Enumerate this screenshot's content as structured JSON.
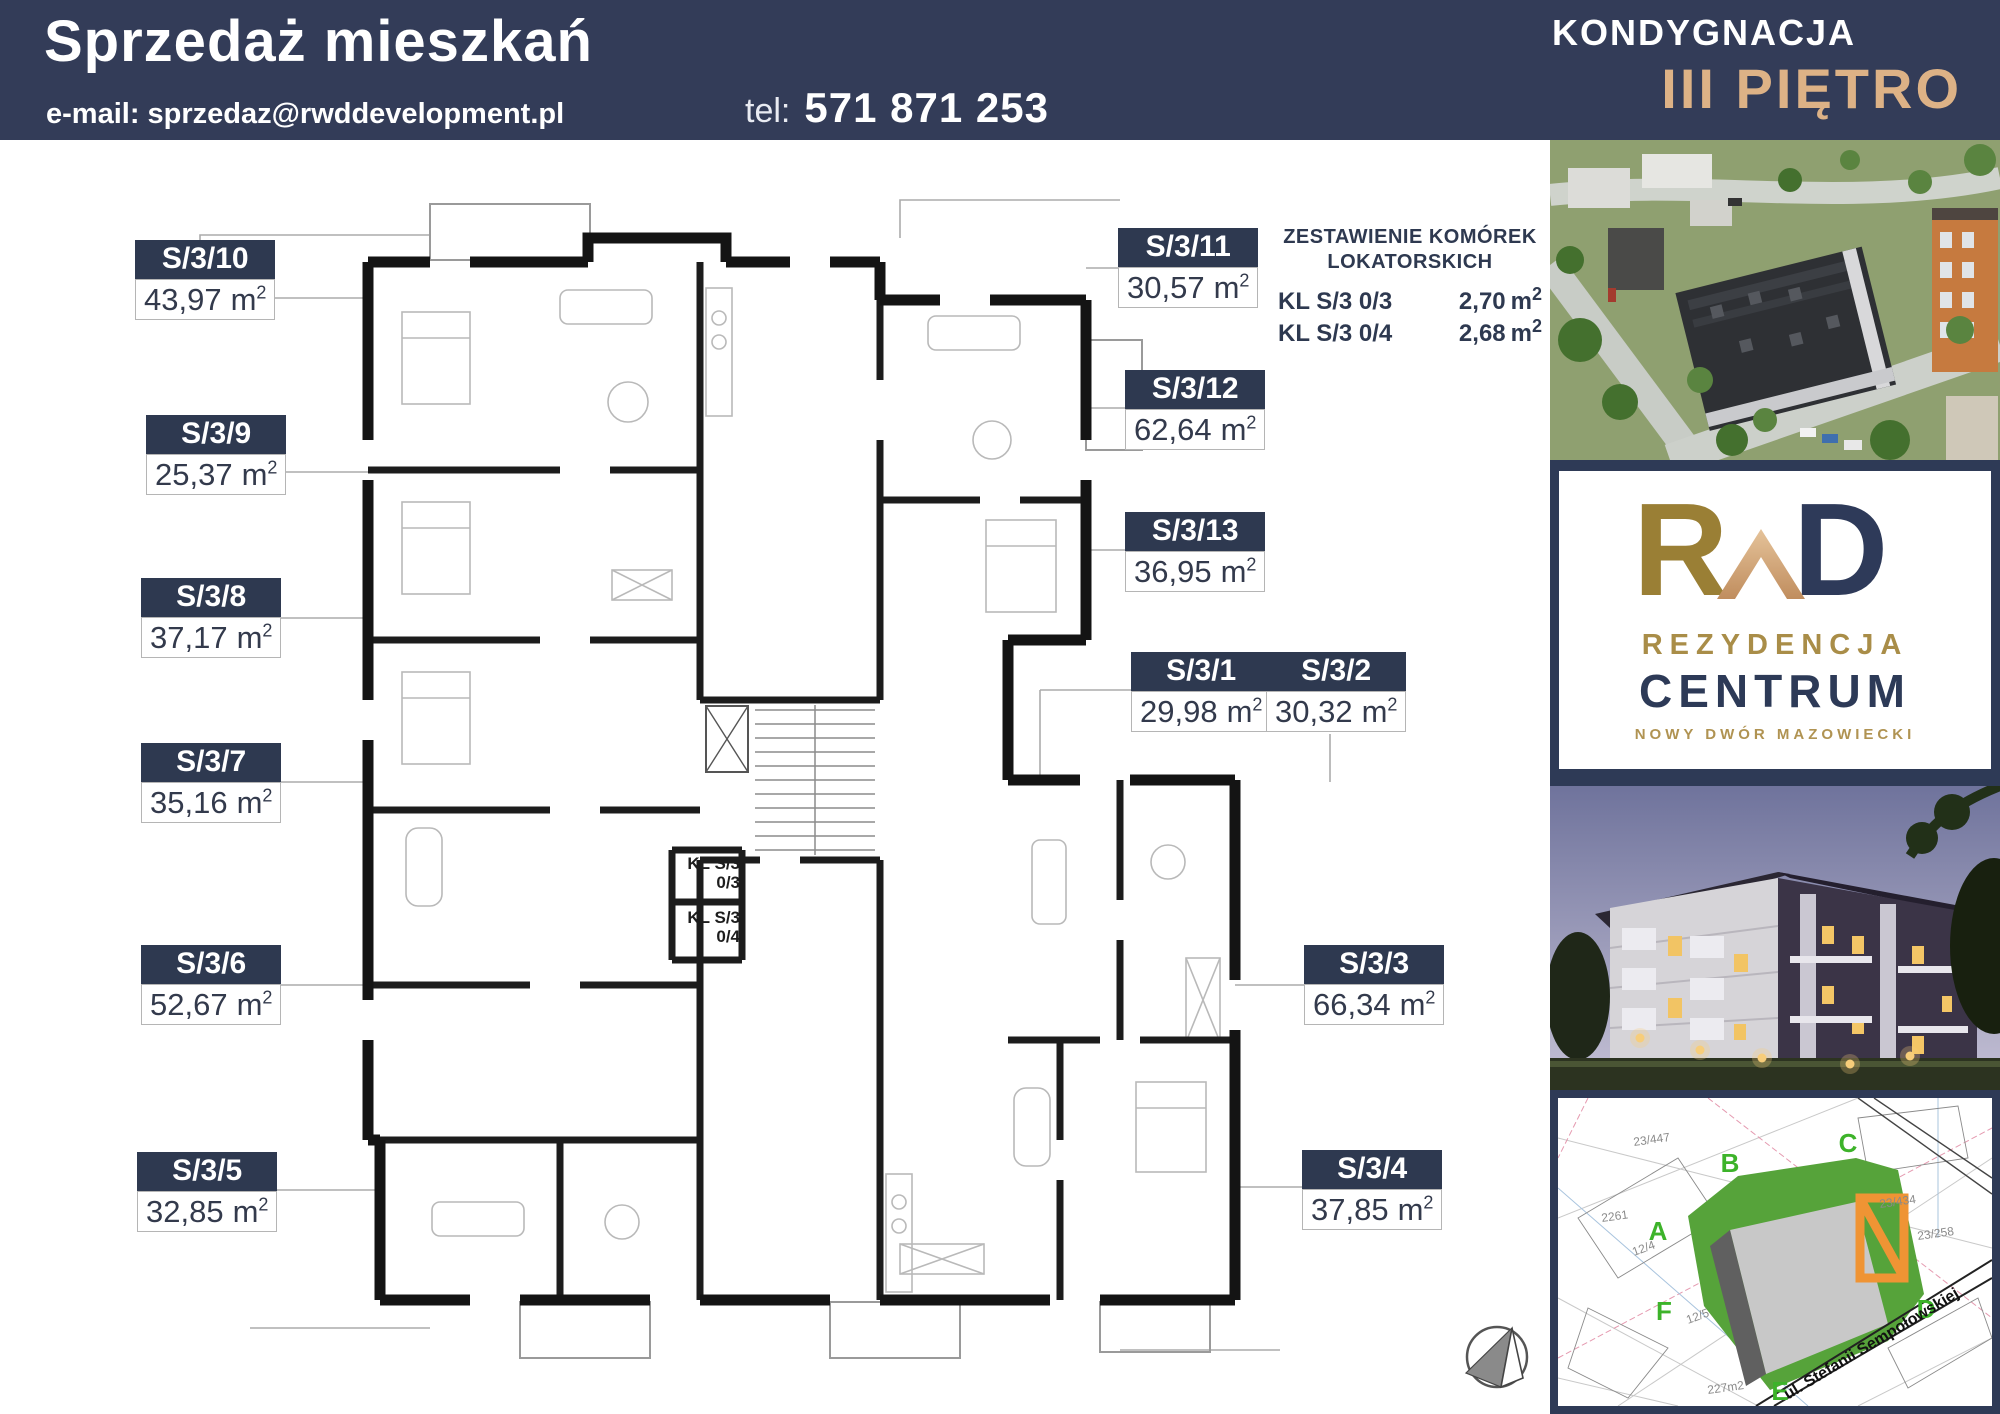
{
  "header": {
    "title": "Sprzedaż mieszkań",
    "email": "e-mail: sprzedaz@rwddevelopment.pl",
    "tel_label": "tel:",
    "tel_number": "571 871 253",
    "kondygnacja": "KONDYGNACJA",
    "floor": "III PIĘTRO"
  },
  "units": {
    "m": "m",
    "sup": "2"
  },
  "apartments": [
    {
      "id": "S/3/10",
      "area": "43,97"
    },
    {
      "id": "S/3/9",
      "area": "25,37"
    },
    {
      "id": "S/3/8",
      "area": "37,17"
    },
    {
      "id": "S/3/7",
      "area": "35,16"
    },
    {
      "id": "S/3/6",
      "area": "52,67"
    },
    {
      "id": "S/3/5",
      "area": "32,85"
    },
    {
      "id": "S/3/11",
      "area": "30,57"
    },
    {
      "id": "S/3/12",
      "area": "62,64"
    },
    {
      "id": "S/3/13",
      "area": "36,95"
    },
    {
      "id": "S/3/1",
      "area": "29,98"
    },
    {
      "id": "S/3/2",
      "area": "30,32"
    },
    {
      "id": "S/3/3",
      "area": "66,34"
    },
    {
      "id": "S/3/4",
      "area": "37,85"
    }
  ],
  "storage": {
    "title_line1": "ZESTAWIENIE KOMÓREK",
    "title_line2": "LOKATORSKICH",
    "rows": [
      {
        "label": "KL S/3 0/3",
        "area": "2,70"
      },
      {
        "label": "KL S/3 0/4",
        "area": "2,68"
      }
    ]
  },
  "kl_boxes": [
    {
      "line1": "KL S/3",
      "line2": "0/3"
    },
    {
      "line1": "KL S/3",
      "line2": "0/4"
    }
  ],
  "logo": {
    "mono_r": "R",
    "mono_d": "D",
    "line1": "REZYDENCJA",
    "line2": "CENTRUM",
    "line3": "NOWY DWÓR MAZOWIECKI"
  },
  "map": {
    "street": "ul. Stefanii Sempołowskiej",
    "markers": [
      "A",
      "B",
      "C",
      "D",
      "E",
      "F"
    ],
    "parcels": [
      "2261",
      "23/447",
      "23/434",
      "23/258",
      "227m2",
      "12/4",
      "12/5"
    ]
  },
  "colors": {
    "navy": "#333c58",
    "label_navy": "#2e3950",
    "gold": "#ddb286",
    "logo_gold": "#9a7f35",
    "site_green": "#56a33a",
    "path_orange": "#ef9434"
  }
}
